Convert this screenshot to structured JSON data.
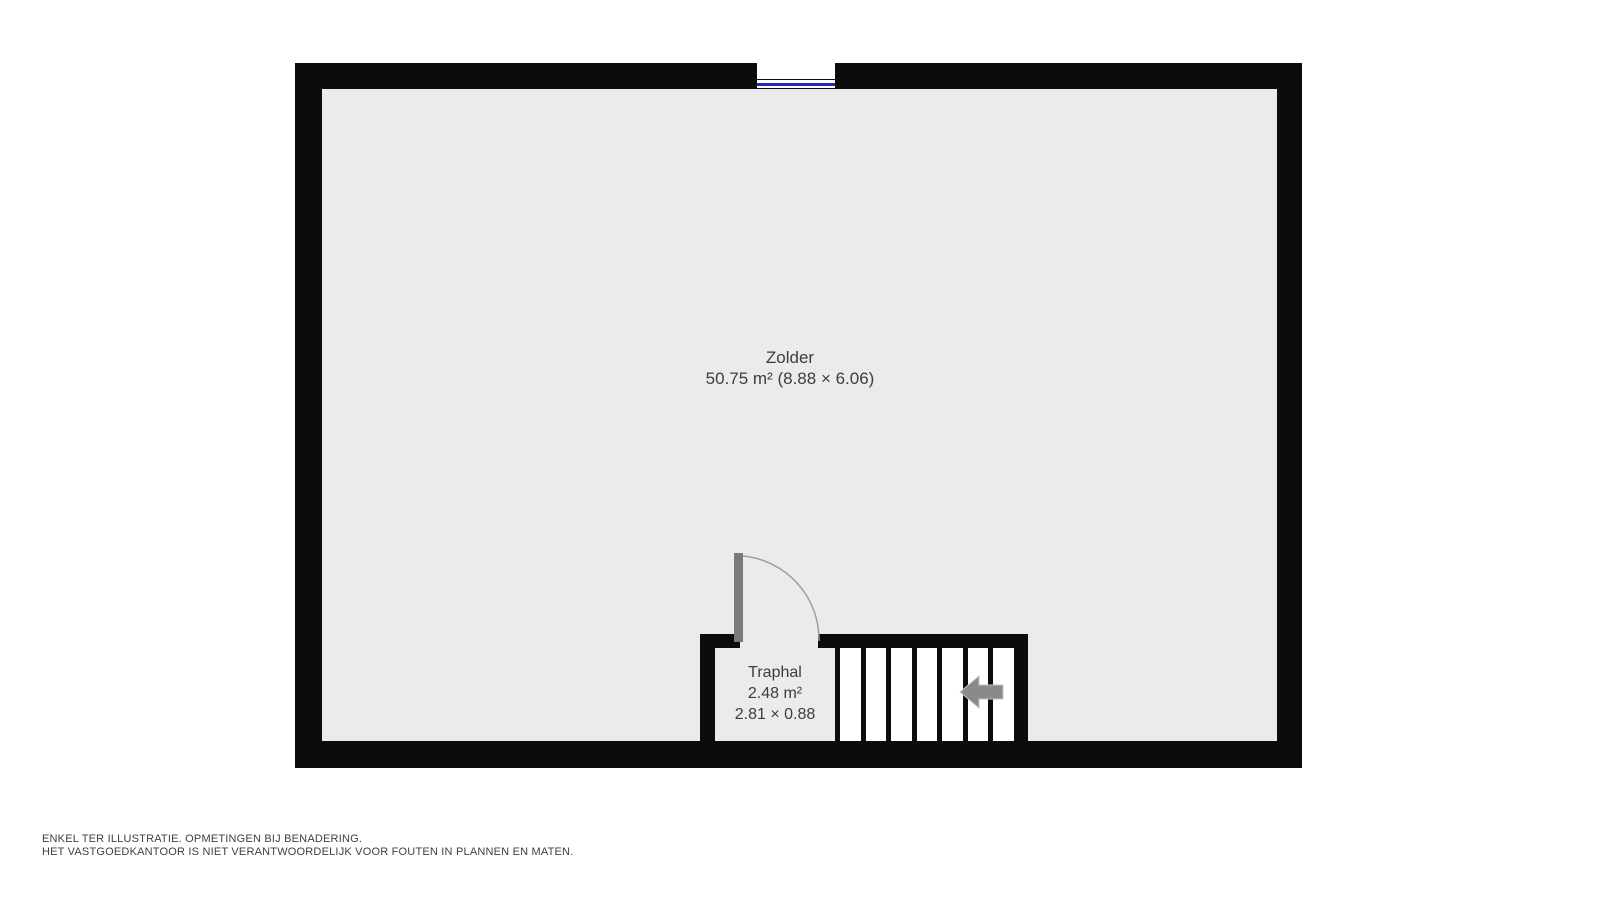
{
  "plan": {
    "rooms": [
      {
        "id": "zolder",
        "name": "Zolder",
        "size_line": "50.75 m² (8.88 × 6.06)"
      },
      {
        "id": "traphal",
        "name": "Traphal",
        "area_line": "2.48 m²",
        "dim_line": "2.81 × 0.88"
      }
    ],
    "stairs": {
      "tread_count": 7,
      "direction": "left"
    },
    "window_count": 1
  },
  "footer": {
    "line1": "ENKEL TER ILLUSTRATIE. OPMETINGEN BIJ BENADERING.",
    "line2": "HET VASTGOEDKANTOOR IS NIET VERANTWOORDELIJK VOOR FOUTEN IN PLANNEN EN MATEN."
  },
  "colors": {
    "wall": "#0c0c0c",
    "floor": "#ebebeb",
    "tread": "#ffffff",
    "door": "#7a7a7a",
    "arc": "#9e9e9e",
    "arrow": "#8a8a8a",
    "arrow_outline": "#c6c6c6",
    "window_glass": "#2828bd",
    "text": "#3d3d3d",
    "footer_text": "#3f3f3f",
    "background": "#ffffff"
  }
}
